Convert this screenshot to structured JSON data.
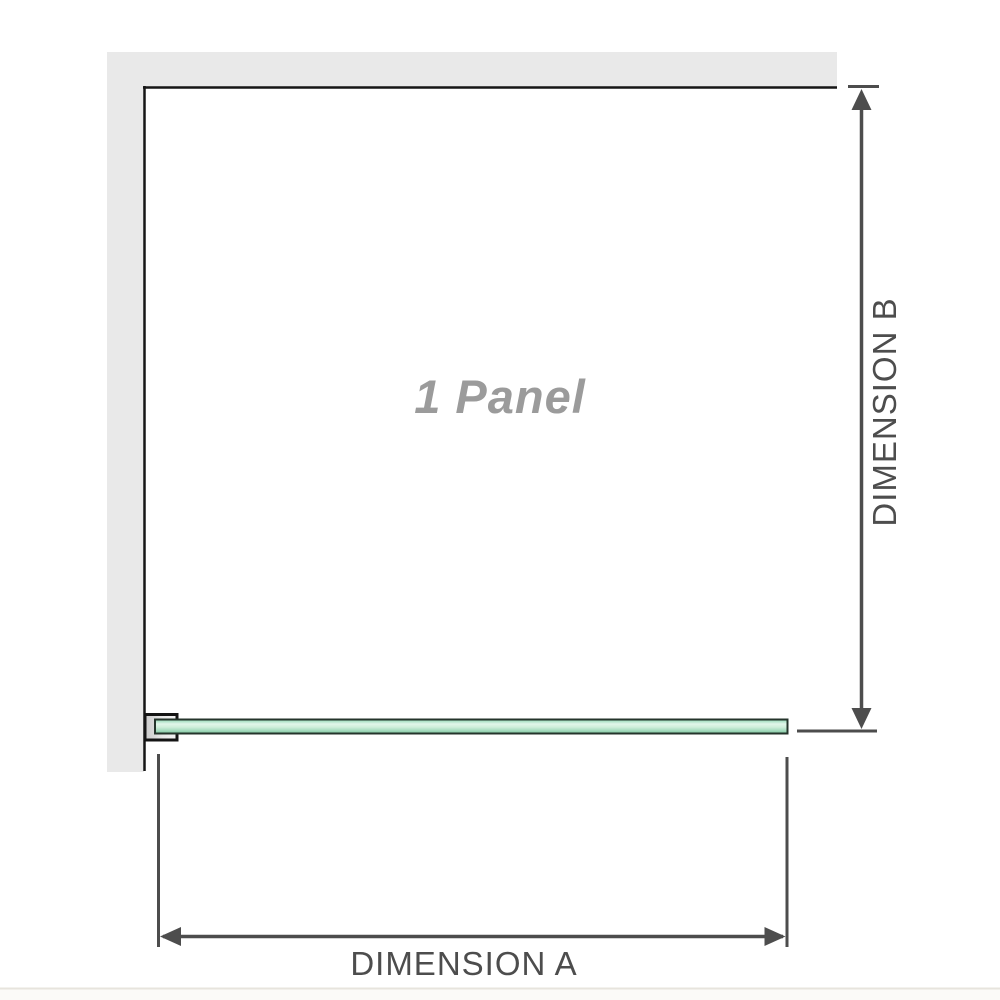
{
  "diagram": {
    "panel_label": "1 Panel",
    "dimension_a_label": "DIMENSION A",
    "dimension_b_label": "DIMENSION B"
  },
  "colors": {
    "background": "#ffffff",
    "wall_fill": "#e9e9e9",
    "wall_edge": "#161616",
    "dimension_lines": "#4d4d4d",
    "dimension_text": "#4d4d4d",
    "panel_label_text": "#9b9b9b",
    "glass_border": "#25342b",
    "glass_green_light": "#e2f6ea",
    "glass_green_mid": "#a8dfc2",
    "glass_green_dark": "#7cc49c",
    "bracket_fill": "#e0e0e0",
    "bracket_outline": "#141414",
    "page_divider": "#e7e4dd",
    "page_below_divider": "#fbfaf8"
  }
}
